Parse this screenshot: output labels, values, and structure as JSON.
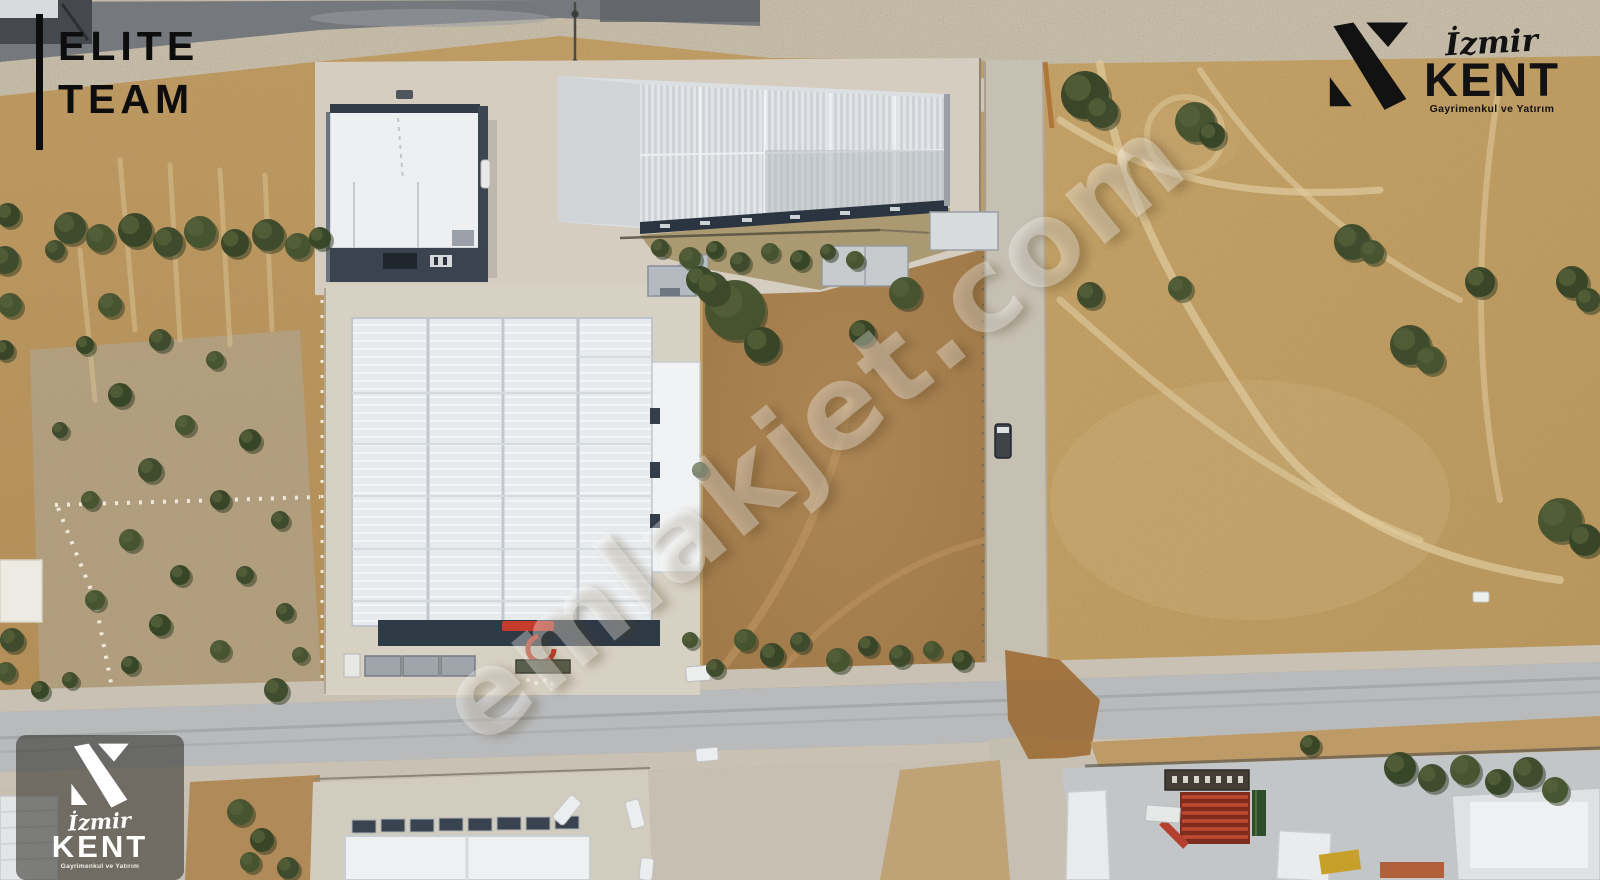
{
  "branding": {
    "elite_team": {
      "line1": "ELITE",
      "line2": "TEAM"
    },
    "izmir_kent": {
      "city": "İzmir",
      "name": "KENT",
      "tagline": "Gayrimenkul ve Yatırım"
    },
    "watermark": "emlakjet.com"
  },
  "colors": {
    "logo_black": "#0d0d0d",
    "logo_white": "#ffffff",
    "badge_background": "rgba(40,38,34,0.55)",
    "watermark_white": "rgba(255,255,255,0.33)",
    "soil_brown": "#aa7f4e",
    "field_tan": "#c6a166",
    "eroded_gray": "#b6a78d",
    "road_gray": "#b8babc",
    "asphalt_dark": "#75787c",
    "concrete": "#d5cfc2",
    "roof_white": "#e8ebed",
    "wall_navy": "#303b49",
    "tree_green": "#3f4c2e",
    "accent_red": "#c63c2c",
    "rust_dirt": "#9c6b33"
  }
}
